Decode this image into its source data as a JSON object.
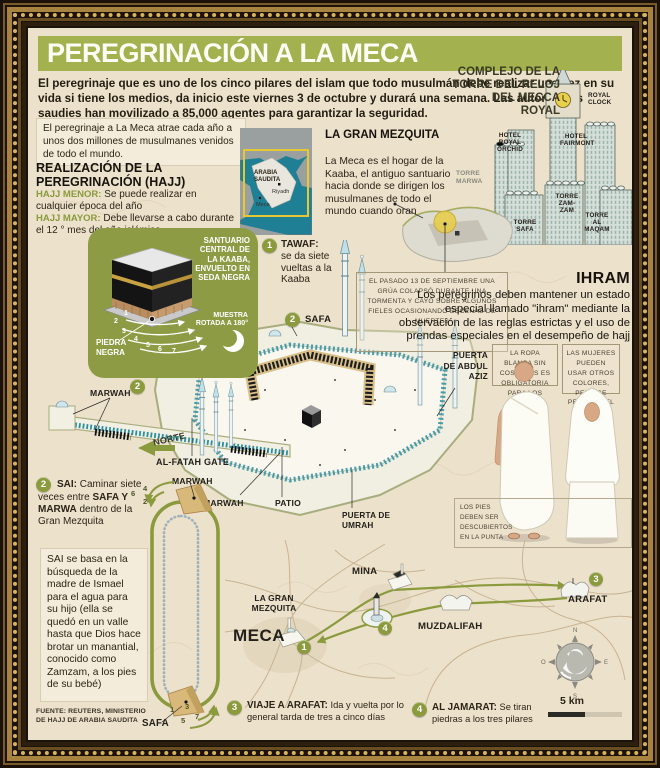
{
  "title": "PEREGRINACIÓN A LA MECA",
  "intro": "El peregrinaje que es uno de los cinco pilares del islam que todo musulmán debe realizar una vez en su vida si tiene los medios, da inicio este viernes 3 de octubre y durará una semana. Las autoridades saudies han movilizado a 85,000 agentes para garantizar la seguridad.",
  "attract_note": "El peregrinaje a La Meca atrae cada año a unos dos millones de musulmanes venidos de todo el mundo.",
  "realizacion": {
    "heading": "REALIZACIÓN DE LA PEREGRINACIÓN (HAJJ)",
    "menor_label": "HAJJ MENOR:",
    "menor_text": " Se puede realizar en cualquier época del año",
    "mayor_label": "HAJJ MAYOR:",
    "mayor_text": " Debe llevarse a cabo durante el 12 ° mes del año islámico"
  },
  "locator_map": {
    "country": "ARABIA SAUDITA",
    "city1": "Riyadh",
    "city2": "Meca"
  },
  "gran_mezquita": {
    "heading": "LA GRAN MEZQUITA",
    "text": "La Meca es el hogar de la Kaaba, el antiguo santuario hacia donde se dirigen los musulmanes de todo el mundo cuando oran"
  },
  "tower_complex": {
    "heading": "COMPLEJO DE LA TORRE DEL RELOJ DEL MECCA ROYAL",
    "royal_clock": "ROYAL CLOCK",
    "hotel_royal_orchid": "HOTEL ROYAL ORCHID",
    "hotel_fairmont": "HOTEL FAIRMONT",
    "torre_marwa": "TORRE MARWA",
    "torre_zamzam": "TORRE ZAM-ZAM",
    "torre_safa": "TORRE SAFA",
    "torre_al_maqam": "TORRE AL MAQAM"
  },
  "kaaba_panel": {
    "sanctuary": "SANTUARIO CENTRAL DE LA KAABA, ENVUELTO EN SEDA NEGRA",
    "rotated": "MUESTRA ROTADA A 180°",
    "black_stone": "PIEDRA NEGRA",
    "lap_numbers": [
      "1",
      "2",
      "3",
      "4",
      "5",
      "6",
      "7"
    ]
  },
  "steps": {
    "tawaf": {
      "num": "1",
      "label": "TAWAF:",
      "text": "se da siete vueltas a la Kaaba"
    },
    "safa": {
      "num": "2",
      "label": "SAFA"
    },
    "sai": {
      "num": "2",
      "label": "SAI:",
      "t1": " Caminar siete veces entre ",
      "bold": "SAFA Y MARWA",
      "t2": " dentro de la Gran Mezquita"
    },
    "arafat": {
      "num": "3",
      "label": "VIAJE A ARAFAT:",
      "text": " Ida y vuelta por lo general tarda de tres a cinco días"
    },
    "jamarat": {
      "num": "4",
      "label": "AL JAMARAT:",
      "text": " Se tiran piedras a los tres pilares"
    }
  },
  "crane_note": "EL PASADO 13 DE SEPTIEMBRE UNA GRÚA COLAPSÓ DURANTE UNA TORMENTA Y CAYÓ SOBRE ALGUNOS FIELES OCASIONANDO DECENAS DE MUERTES",
  "ihram": {
    "heading": "IHRAM",
    "text": "Los peregrinos deben mantener un estado especial llamado \"ihram\" mediante la observación de las reglas estrictas y el uso de prendas especiales en el desempeño de hajj",
    "men_note": "LA ROPA BLANCA SIN COSTURAS ES OBLIGATORIA PARA LOS HOMBRES",
    "women_note": "LAS MUJERES PUEDEN USAR OTROS COLORES, PERO SE PREFIERE EL BLANCO",
    "feet_note": "LOS PIES DEBEN SER DESCUBIERTOS EN LA PUNTA"
  },
  "mosque": {
    "marwah": "MARWAH",
    "safa": "SAFA",
    "norte": "NORTE",
    "al_fatah_gate": "AL-FATAH GATE",
    "patio": "PATIO",
    "puerta_umrah": "PUERTA DE UMRAH",
    "puerta_abdul_aziz": "PUERTA DE ABDUL AZIZ"
  },
  "sai_story": "SAI se basa en la búsqueda de la madre de Ismael para el agua para su hijo (ella se quedó en un valle hasta que Dios hace brotar un manantial, conocido como Zamzam, a los pies de su bebé)",
  "sai_diagram": {
    "marwah": "MARWAH",
    "safa": "SAFA",
    "up_numbers": [
      "6",
      "4",
      "2"
    ],
    "down_numbers": [
      "1",
      "3",
      "5",
      "7"
    ]
  },
  "route_map": {
    "la_gran_mezquita": "LA GRAN MEZQUITA",
    "meca": "MECA",
    "mina": "MINA",
    "muzdalifah": "MUZDALIFAH",
    "arafat": "ARAFAT",
    "stop_meca": "1",
    "stop_arafat": "3",
    "stop_jamarat": "4",
    "scale": "5 km",
    "compass": {
      "n": "N",
      "e": "E",
      "s": "S",
      "o": "O"
    }
  },
  "source": "FUENTE: REUTERS, MINISTERIO DE HAJJ DE ARABIA SAUDITA",
  "colors": {
    "title_green": "#a4b14f",
    "accent_green": "#8a9a3d",
    "panel_green": "#8d9c44",
    "teal": "#2b8fa0",
    "parchment": "#ece1cb",
    "ink": "#1e1a12"
  }
}
